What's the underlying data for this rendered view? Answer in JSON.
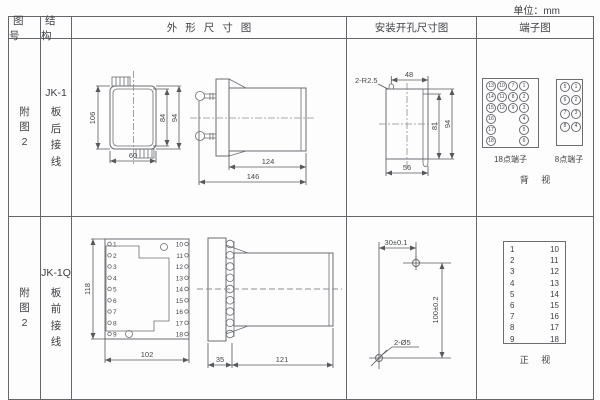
{
  "unit_label": "单位：mm",
  "headers": {
    "fig_no": "图号",
    "structure": "结构",
    "outline": "外形尺寸图",
    "mounting": "安装开孔尺寸图",
    "terminal": "端子图"
  },
  "row1": {
    "fig_no": [
      "附",
      "图",
      "2"
    ],
    "structure": {
      "model": "JK-1",
      "chars": [
        "板",
        "后",
        "接",
        "线"
      ]
    },
    "outline": {
      "h106": "106",
      "h84": "84",
      "h94": "94",
      "w60": "60",
      "l124": "124",
      "l146": "146"
    },
    "mounting": {
      "slot": "2-R2.5",
      "w48": "48",
      "h81": "81",
      "h94": "94",
      "w56": "56"
    },
    "terminal": {
      "b18": {
        "label": "18点端子",
        "c1": [
          "13",
          "14",
          "15",
          "16",
          "17",
          "18"
        ],
        "c2": [
          "10",
          "11",
          "12"
        ],
        "c3": [
          "7",
          "8",
          "9"
        ],
        "c4": [
          "1",
          "2",
          "3",
          "4",
          "5",
          "6"
        ]
      },
      "b8": {
        "label": "8点端子",
        "c1": [
          "5",
          "6",
          "7",
          "8"
        ],
        "c2": [
          "1",
          "2",
          "3",
          "4"
        ]
      },
      "view": "背 视"
    }
  },
  "row2": {
    "fig_no": [
      "附",
      "图",
      "2"
    ],
    "structure": {
      "model": "JK-1Q",
      "chars": [
        "板",
        "前",
        "接",
        "线"
      ]
    },
    "outline": {
      "h118": "118",
      "w102": "102",
      "d35": "35",
      "d121": "121",
      "left": [
        "1",
        "2",
        "3",
        "4",
        "5",
        "6",
        "7",
        "8",
        "9"
      ],
      "right": [
        "10",
        "11",
        "12",
        "13",
        "14",
        "15",
        "16",
        "17",
        "18"
      ]
    },
    "mounting": {
      "w30": "30±0.1",
      "h100": "100±0.2",
      "hole": "2-Ø5"
    },
    "terminal": {
      "left": [
        "1",
        "2",
        "3",
        "4",
        "5",
        "6",
        "7",
        "8",
        "9"
      ],
      "right": [
        "10",
        "11",
        "12",
        "13",
        "14",
        "15",
        "16",
        "17",
        "18"
      ],
      "view": "正 视"
    }
  }
}
